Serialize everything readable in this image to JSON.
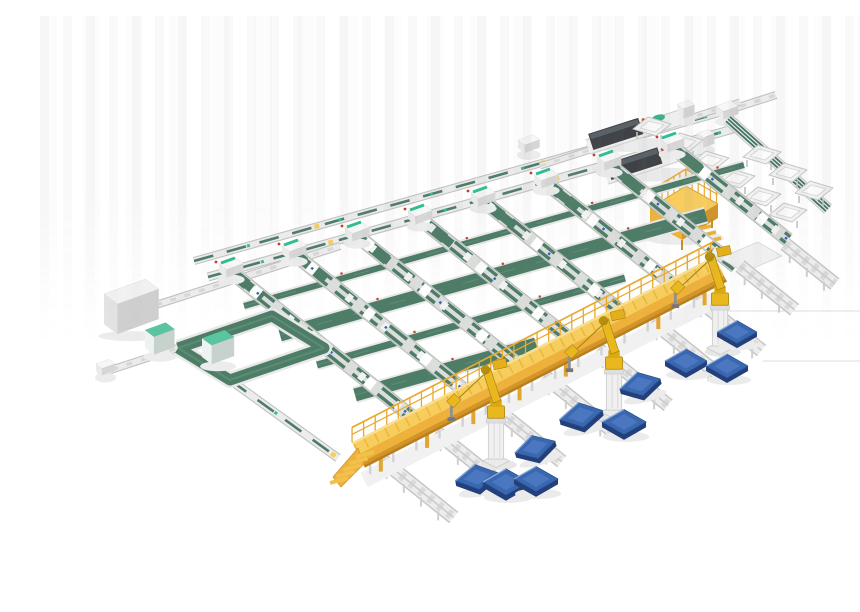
{
  "meta": {
    "description": "Isometric 3D render of an automated production line: grid of green belt conveyor lanes, transfer loop, wrapping machines, elevated yellow operator walkway with stairs, yellow palletizing robots on white pedestals, blue pallets, maintenance platform and outfeed tote stations",
    "background": "#ffffff"
  },
  "colors": {
    "green": "#4d7c67",
    "green_dark": "#3a614f",
    "green_light": "#5d8b75",
    "teal": "#2fbe92",
    "frame": "#ececec",
    "frame_mid": "#d8d8d8",
    "frame_dark": "#c2c2c2",
    "lane_base": "#dcdedc",
    "lane_edge": "#bcc0bc",
    "walk_top": "#f7cd5e",
    "walk_deck_hi": "#fadf91",
    "walk_face": "#eeb23c",
    "walk_dark": "#d3952a",
    "walk_kick": "#b97f1d",
    "walk_rail": "#e9a92e",
    "robot_yellow": "#e9b81e",
    "robot_mid": "#f0c12e",
    "robot_shade": "#a8830e",
    "pallet_top": "#3a68b0",
    "pallet_inner": "#4a77c0",
    "pallet_side": "#23407a",
    "pallet_hi": "#89a9d9",
    "machine_dark": "#3e4247",
    "machine_ridge": "#596066",
    "machine_green": "#37b289",
    "dot_red": "#c43b2c",
    "dot_blue": "#2d5fc7",
    "shadow": "#ececec",
    "artifact": "#dddddd"
  },
  "counts": {
    "conveyor_lanes": 8,
    "cross_belts": 4,
    "robots": 3,
    "pallets": 10,
    "outfeed_trays": 9,
    "walkway_beds": 9,
    "machines": 2
  },
  "scene": {
    "artifact_lines": [
      [
        687,
        295,
        860,
        295
      ],
      [
        723,
        345,
        860,
        345
      ]
    ],
    "rails": [
      {
        "p": [
          154,
          245,
          686,
          95
        ],
        "w": 7,
        "green": true,
        "name": "top-conveyor-line"
      },
      {
        "p": [
          168,
          261,
          700,
          111
        ],
        "w": 8,
        "green": true,
        "name": "header-conveyor-line"
      },
      {
        "p": [
          686,
          95,
          736,
          79
        ],
        "w": 7,
        "green": false,
        "name": "corner-stub-conveyor"
      },
      {
        "p": [
          116,
          289,
          300,
          230
        ],
        "w": 7,
        "green": false,
        "name": "infeed-conveyor"
      },
      {
        "p": [
          500,
          150,
          700,
          86
        ],
        "w": 6,
        "green": false,
        "name": "machine-support-line"
      },
      {
        "p": [
          58,
          358,
          138,
          332
        ],
        "w": 7,
        "green": false,
        "name": "loop-spur-conveyor"
      },
      {
        "p": [
          190,
          364,
          298,
          442
        ],
        "w": 8,
        "green": true,
        "name": "loop-to-walkway-conveyor"
      }
    ],
    "machines": [
      {
        "p": [
          548,
          131,
          648,
          99
        ]
      },
      {
        "p": [
          566,
          161,
          668,
          128
        ]
      }
    ],
    "small_boxes": [
      {
        "x": 478,
        "y": 124,
        "w": 16,
        "d": 9,
        "h": 8
      },
      {
        "x": 676,
        "y": 90,
        "w": 16,
        "d": 10,
        "h": 8
      },
      {
        "x": 56,
        "y": 348,
        "w": 14,
        "d": 8,
        "h": 7
      }
    ],
    "spine": {
      "p": [
        688,
        103,
        788,
        193
      ]
    },
    "trays": [
      [
        644,
        126
      ],
      [
        670,
        144
      ],
      [
        696,
        162
      ],
      [
        722,
        180
      ],
      [
        722,
        138
      ],
      [
        748,
        156
      ],
      [
        774,
        174
      ],
      [
        748,
        196
      ],
      [
        612,
        110
      ]
    ],
    "platform": {
      "top": [
        [
          610,
          192
        ],
        [
          646,
          170
        ],
        [
          678,
          188
        ],
        [
          642,
          210
        ]
      ],
      "h": 14,
      "rail_h": 17,
      "stairs": [
        650,
        206
      ]
    },
    "cross_bands": [
      {
        "p": [
          204,
          290,
          704,
          149
        ],
        "w": 6
      },
      {
        "p": [
          240,
          319,
          666,
          199
        ],
        "w": 13
      },
      {
        "p": [
          277,
          349,
          585,
          262
        ],
        "w": 7
      },
      {
        "p": [
          315,
          379,
          496,
          328
        ],
        "w": 13
      }
    ],
    "lanes": {
      "dir": [
        0.78,
        0.625
      ],
      "heads": [
        [
          190,
          255
        ],
        [
          253,
          237
        ],
        [
          316,
          219
        ],
        [
          379,
          202
        ],
        [
          442,
          184
        ],
        [
          505,
          166
        ],
        [
          568,
          148
        ],
        [
          631,
          130
        ]
      ],
      "lens": [
        236,
        222,
        211,
        198,
        187,
        176,
        164,
        150
      ]
    },
    "loop": {
      "pts": [
        [
          138,
          332
        ],
        [
          232,
          300
        ],
        [
          284,
          332
        ],
        [
          190,
          364
        ]
      ]
    },
    "cubes": [
      {
        "x": 64,
        "y": 278,
        "w": 44,
        "d": 18,
        "h": 30,
        "top": "#f1f1f1",
        "left": "#e3e3e3",
        "right": "#cfcfcf",
        "name": "gray-cabinet"
      },
      {
        "x": 105,
        "y": 314,
        "w": 22,
        "d": 12,
        "h": 18,
        "top": "#5ac5a1",
        "left": "#eef2f0",
        "right": "#c8d2cd",
        "name": "teal-machine"
      },
      {
        "x": 162,
        "y": 322,
        "w": 24,
        "d": 13,
        "h": 19,
        "top": "#5ac5a1",
        "left": "#eef2f0",
        "right": "#c8d2cd",
        "name": "teal-machine"
      }
    ],
    "landing": [
      [
        680,
        242
      ],
      [
        718,
        226
      ],
      [
        742,
        240
      ],
      [
        704,
        256
      ]
    ],
    "beds": {
      "dir": [
        0.78,
        0.625
      ],
      "items": [
        [
          342,
          444,
          92
        ],
        [
          396,
          416,
          92
        ],
        [
          450,
          388,
          92
        ],
        [
          504,
          360,
          92
        ],
        [
          558,
          333,
          90
        ],
        [
          612,
          305,
          88
        ],
        [
          656,
          282,
          84
        ],
        [
          700,
          250,
          70
        ],
        [
          745,
          228,
          64
        ]
      ]
    },
    "walkway": {
      "p": [
        318,
        438,
        680,
        252
      ]
    },
    "robots": [
      [
        456,
        445
      ],
      [
        574,
        396
      ],
      [
        680,
        332
      ]
    ],
    "pallets": [
      [
        697,
        316,
        0,
        0.95
      ],
      [
        646,
        345,
        0,
        1.0
      ],
      [
        687,
        350,
        0,
        1.0
      ],
      [
        600,
        368,
        -14,
        1.0
      ],
      [
        541,
        399,
        -12,
        1.05
      ],
      [
        584,
        406,
        0,
        1.05
      ],
      [
        495,
        431,
        -16,
        1.0
      ],
      [
        437,
        461,
        -10,
        1.05
      ],
      [
        466,
        466,
        0,
        1.1
      ],
      [
        496,
        463,
        0,
        1.05
      ]
    ]
  }
}
